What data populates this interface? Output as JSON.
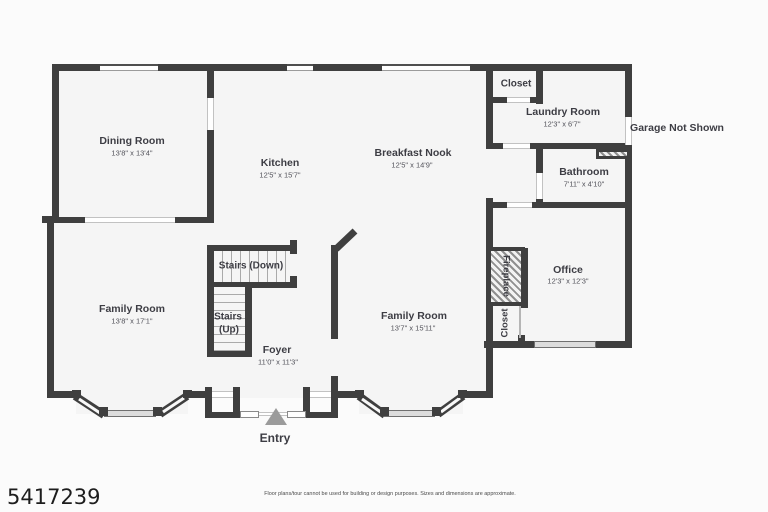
{
  "rooms": {
    "dining": {
      "name": "Dining Room",
      "dims": "13'8\" x 13'4\""
    },
    "kitchen": {
      "name": "Kitchen",
      "dims": "12'5\" x 15'7\""
    },
    "breakfast_nook": {
      "name": "Breakfast Nook",
      "dims": "12'5\" x 14'9\""
    },
    "closet_top": {
      "name": "Closet"
    },
    "laundry": {
      "name": "Laundry Room",
      "dims": "12'3\" x 6'7\""
    },
    "bathroom": {
      "name": "Bathroom",
      "dims": "7'11\" x 4'10\""
    },
    "office": {
      "name": "Office",
      "dims": "12'3\" x 12'3\""
    },
    "family_left": {
      "name": "Family Room",
      "dims": "13'8\" x 17'1\""
    },
    "family_right": {
      "name": "Family Room",
      "dims": "13'7\" x 15'11\""
    },
    "stairs_down": {
      "name": "Stairs (Down)"
    },
    "stairs_up": {
      "line1": "Stairs",
      "line2": "(Up)"
    },
    "foyer": {
      "name": "Foyer",
      "dims": "11'0\" x 11'3\""
    },
    "fireplace": {
      "name": "Fireplace"
    },
    "closet_bottom": {
      "name": "Closet"
    }
  },
  "annotations": {
    "garage": "Garage Not Shown",
    "entry": "Entry"
  },
  "footer": {
    "listing_number": "5417239",
    "disclaimer": "Floor plans/tour cannot be used for building or design purposes. Sizes and dimensions are approximate."
  },
  "colors": {
    "wall": "#3f3f3f",
    "floor": "#f5f5f5",
    "label": "#3d3d44",
    "window_gray": "#dcdcdc",
    "entry_arrow": "#9b9b9b"
  }
}
